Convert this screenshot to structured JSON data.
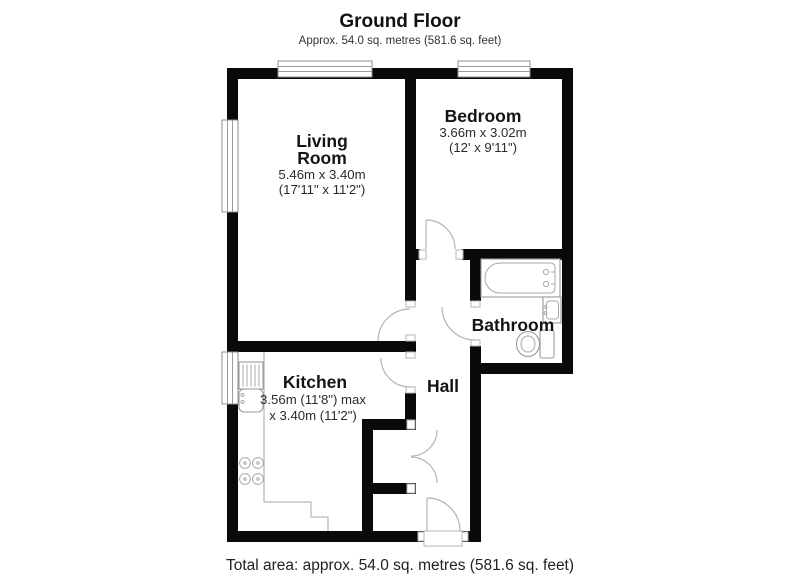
{
  "header": {
    "title": "Ground Floor",
    "subtitle": "Approx. 54.0 sq. metres (581.6 sq. feet)"
  },
  "footer": {
    "total_area": "Total area: approx. 54.0 sq. metres (581.6 sq. feet)"
  },
  "rooms": {
    "living_room": {
      "name_line1": "Living",
      "name_line2": "Room",
      "dims_metric": "5.46m x 3.40m",
      "dims_imperial": "(17'11\" x 11'2\")"
    },
    "bedroom": {
      "name": "Bedroom",
      "dims_metric": "3.66m x 3.02m",
      "dims_imperial": "(12' x 9'11\")"
    },
    "kitchen": {
      "name": "Kitchen",
      "dims_line1": "3.56m (11'8\") max",
      "dims_line2": "x 3.40m (11'2\")"
    },
    "hall": {
      "name": "Hall"
    },
    "bathroom": {
      "name": "Bathroom"
    }
  },
  "icons": {
    "fixtures": [
      "bathtub-icon",
      "bathroom-sink-icon",
      "toilet-icon",
      "kitchen-sink-icon",
      "stove-icon",
      "kitchen-counter-icon"
    ],
    "openings": [
      "window-icon",
      "door-arc-icon"
    ]
  },
  "colors": {
    "wall": "#0a0a0a",
    "fixture_line": "#9a9a9a",
    "door_arc": "#b3b3b3",
    "text": "#141414",
    "background": "#ffffff"
  }
}
